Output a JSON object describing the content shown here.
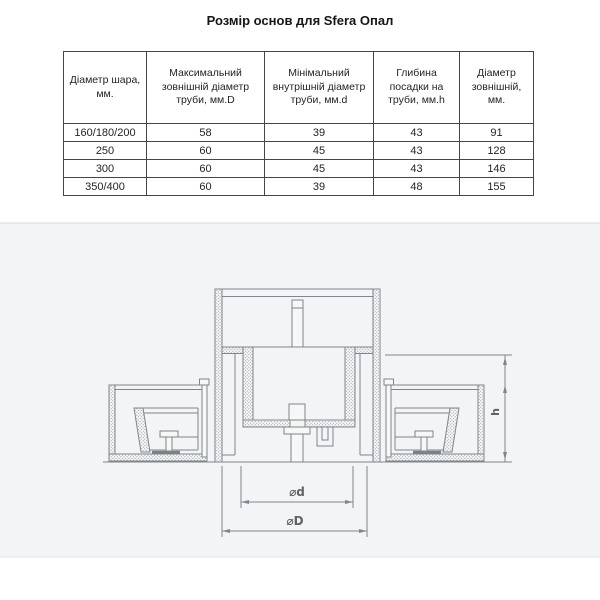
{
  "title": "Розмір основ для Sfera Опал",
  "table": {
    "headers": [
      "Діаметр шара, мм.",
      "Максимальний зовнішній діаметр труби, мм.D",
      "Мінімальний внутрішній діаметр труби, мм.d",
      "Глибина посадки на труби, мм.h",
      "Діаметр зовнішній, мм."
    ],
    "rows": [
      [
        "160/180/200",
        "58",
        "39",
        "43",
        "91"
      ],
      [
        "250",
        "60",
        "45",
        "43",
        "128"
      ],
      [
        "300",
        "60",
        "45",
        "43",
        "146"
      ],
      [
        "350/400",
        "60",
        "39",
        "48",
        "155"
      ]
    ]
  },
  "drawing": {
    "labels": {
      "inner_diameter": "⌀d",
      "outer_diameter": "⌀D",
      "seat_depth": "h"
    }
  },
  "colors": {
    "line": "#80868b",
    "table_border": "#454545",
    "drawing_background": "#f3f4f5",
    "text": "#242424"
  }
}
